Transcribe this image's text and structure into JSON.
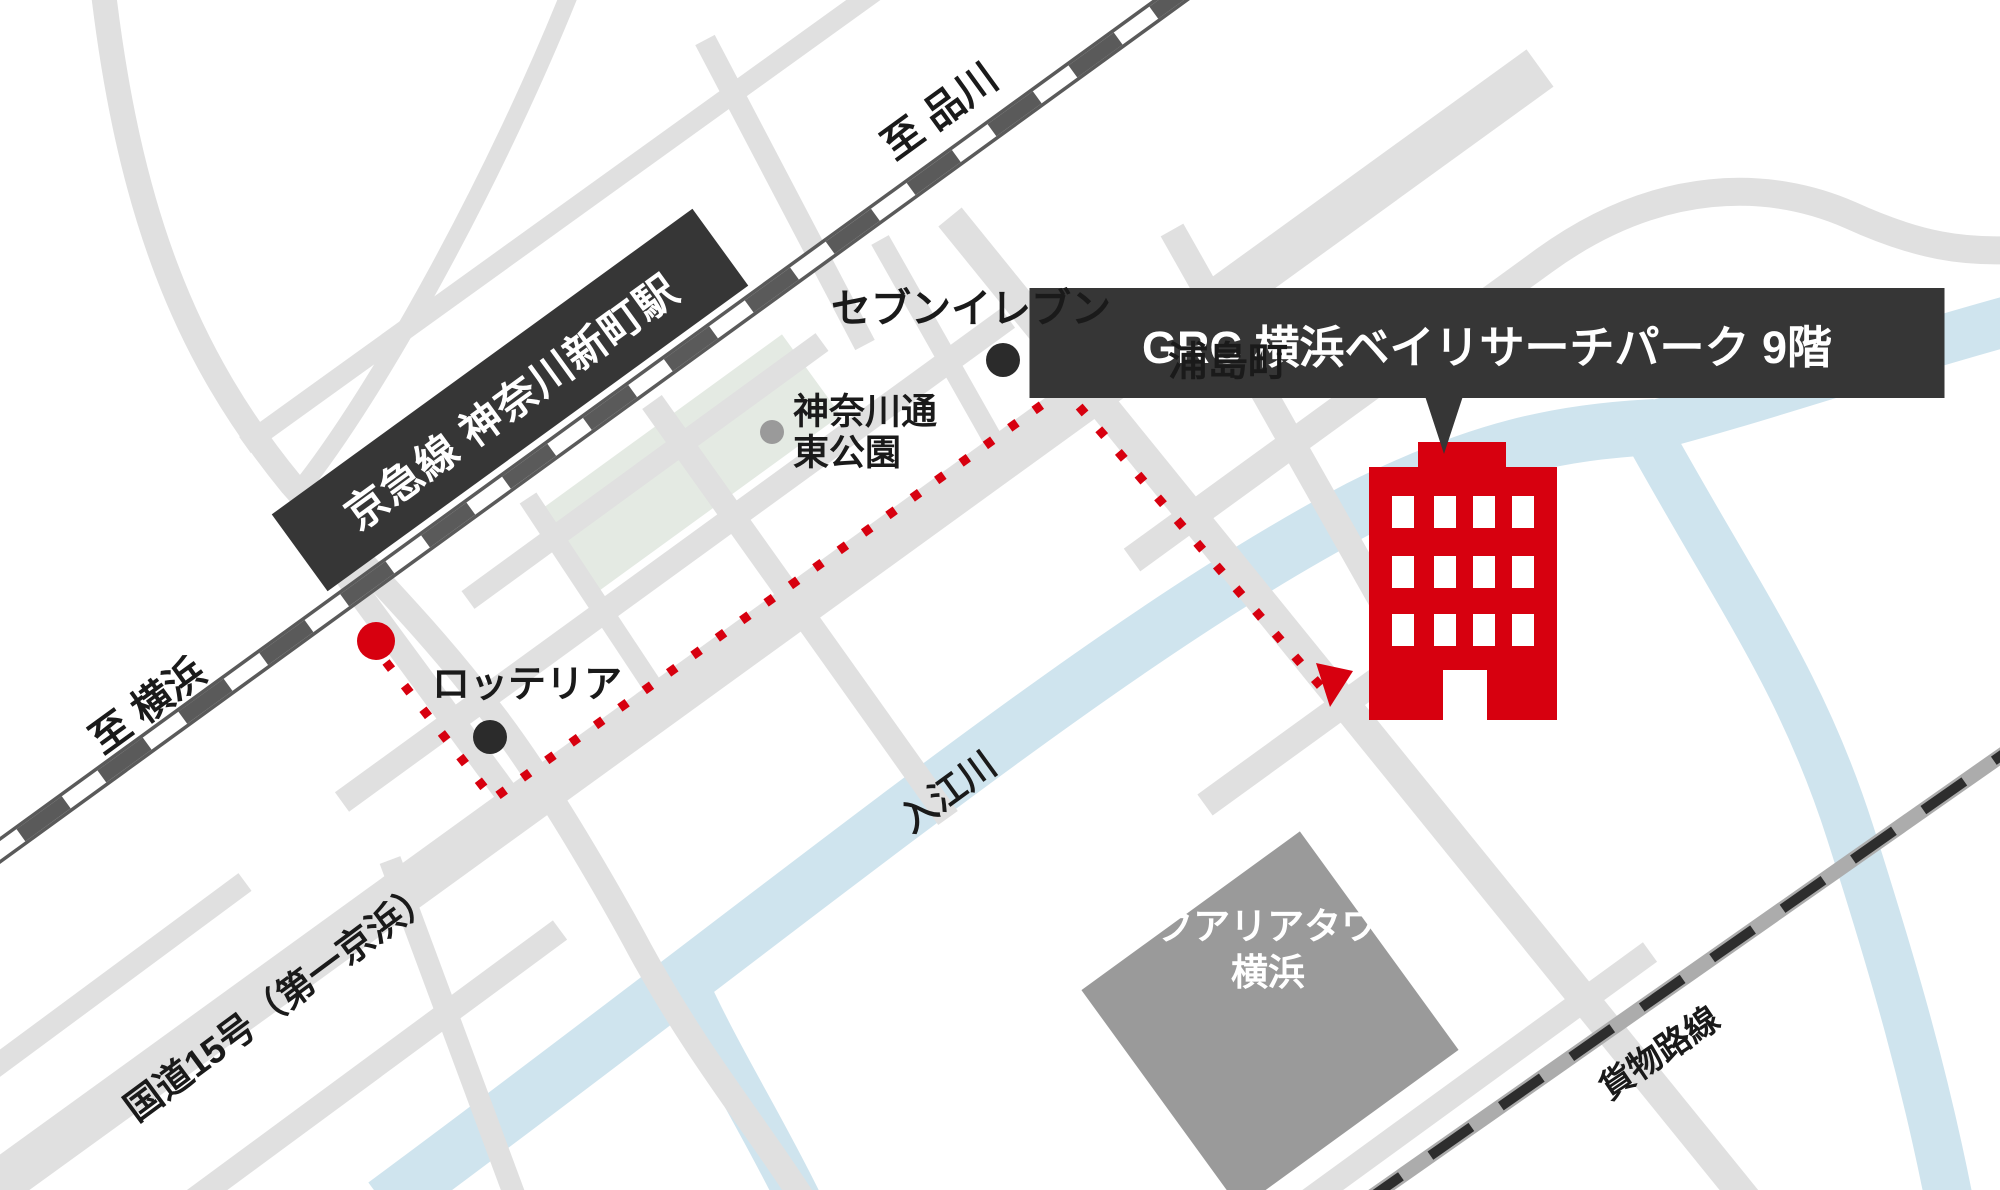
{
  "map": {
    "title": "GRC 横浜ベイリサーチパーク アクセスマップ",
    "labels": {
      "to_shinagawa": "至 品川",
      "to_yokohama": "至 横浜",
      "station": "京急線 神奈川新町駅",
      "destination": "GRC 横浜ベイリサーチパーク 9階",
      "seven_eleven": "セブンイレブン",
      "urashimacho": "浦島町",
      "park_line1": "神奈川通",
      "park_line2": "東公園",
      "lotteria": "ロッテリア",
      "river": "入江川",
      "aqualia_line1": "アクアリアタワー",
      "aqualia_line2": "横浜",
      "route15": "国道15号（第一京浜）",
      "freight_line": "貨物路線"
    },
    "colors": {
      "red": "#d7000f",
      "dark": "#363636",
      "road": "#e0e0e0",
      "river": "#cfe4ee",
      "park": "#e4eae3",
      "rail_gray": "#5a5a5a",
      "freight_gray": "#acacac",
      "freight_dash": "#2d2d2d",
      "building_gray": "#9a9a9a",
      "traffic_gray": "#8f8f8f",
      "poi_dot": "#2b2b2b",
      "text": "#1a1a1a"
    }
  }
}
